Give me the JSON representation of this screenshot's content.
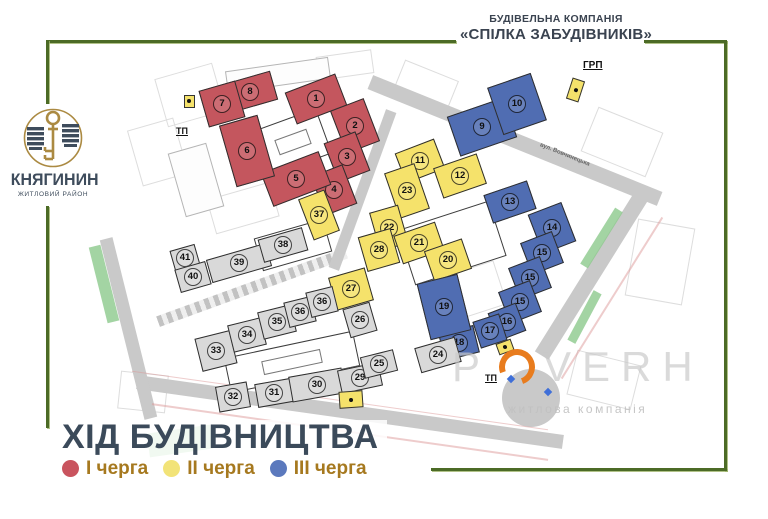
{
  "header": {
    "line1": "БУДІВЕЛЬНА КОМПАНІЯ",
    "line2": "«СПІЛКА ЗАБУДІВНИКІВ»"
  },
  "logo": {
    "name": "КНЯГИНИН",
    "subtitle": "ЖИТЛОВИЙ РАЙОН",
    "gold": "#ab8a42",
    "dark": "#3e4c5c"
  },
  "title": "ХІД БУДІВНИЦТВА",
  "legend": [
    {
      "label": "І черга",
      "color": "#c9545e"
    },
    {
      "label": "ІІ черга",
      "color": "#f2e378"
    },
    {
      "label": "ІІІ черга",
      "color": "#5b79bd"
    }
  ],
  "watermark": {
    "part1": "P",
    "part2": "VERH",
    "subtitle": "житлова компанія",
    "accent": "#e87c1e"
  },
  "frame_color": "#4c6b26",
  "map": {
    "colors": {
      "phase1": "#c4565e",
      "phase2": "#f5e26b",
      "phase3": "#506db2",
      "gray": "#d9d9d9",
      "road": "#c9c9c9",
      "green": "#8cc98c",
      "outline": "#2e2e2e"
    },
    "shapes": [
      {
        "t": "parcel",
        "x": 190,
        "y": 95,
        "w": 60,
        "h": 50,
        "r": -16
      },
      {
        "t": "parcel",
        "x": 158,
        "y": 152,
        "w": 48,
        "h": 58,
        "r": -16
      },
      {
        "t": "parcel",
        "x": 425,
        "y": 88,
        "w": 58,
        "h": 38,
        "r": 22
      },
      {
        "t": "parcel",
        "x": 622,
        "y": 142,
        "w": 70,
        "h": 48,
        "r": 22
      },
      {
        "t": "parcel",
        "x": 660,
        "y": 262,
        "w": 58,
        "h": 78,
        "r": 10
      },
      {
        "t": "parcel",
        "x": 470,
        "y": 292,
        "w": 64,
        "h": 46,
        "r": -18
      },
      {
        "t": "parcel",
        "x": 243,
        "y": 208,
        "w": 66,
        "h": 36,
        "r": -16
      },
      {
        "t": "parcel",
        "x": 604,
        "y": 380,
        "w": 66,
        "h": 46,
        "r": 14
      },
      {
        "t": "parcel",
        "x": 143,
        "y": 392,
        "w": 48,
        "h": 38,
        "r": 6
      },
      {
        "t": "parcel",
        "x": 345,
        "y": 65,
        "w": 56,
        "h": 24,
        "r": -8
      },
      {
        "t": "road",
        "x": 515,
        "y": 140,
        "w": 312,
        "h": 15,
        "r": 22
      },
      {
        "t": "road",
        "x": 592,
        "y": 275,
        "w": 16,
        "h": 190,
        "r": 32
      },
      {
        "t": "road",
        "x": 350,
        "y": 412,
        "w": 430,
        "h": 14,
        "r": 8
      },
      {
        "t": "road",
        "x": 128,
        "y": 328,
        "w": 13,
        "h": 185,
        "r": -14
      },
      {
        "t": "roadz",
        "x": 252,
        "y": 287,
        "w": 200,
        "h": 11,
        "r": -20
      },
      {
        "t": "road",
        "x": 362,
        "y": 190,
        "w": 11,
        "h": 168,
        "r": 20
      },
      {
        "t": "green",
        "x": 601,
        "y": 238,
        "w": 9,
        "h": 66,
        "r": 32
      },
      {
        "t": "green",
        "x": 584,
        "y": 317,
        "w": 9,
        "h": 56,
        "r": 28
      },
      {
        "t": "green",
        "x": 180,
        "y": 441,
        "w": 64,
        "h": 24,
        "r": -8
      },
      {
        "t": "green",
        "x": 104,
        "y": 284,
        "w": 12,
        "h": 78,
        "r": -14
      },
      {
        "t": "junction",
        "x": 531,
        "y": 398,
        "w": 58,
        "h": 58,
        "r": 0
      },
      {
        "t": "rline",
        "x": 350,
        "y": 432,
        "w": 400,
        "h": 2,
        "r": 8
      },
      {
        "t": "rline",
        "x": 340,
        "y": 400,
        "w": 420,
        "h": 1,
        "r": 8
      },
      {
        "t": "rline",
        "x": 612,
        "y": 298,
        "w": 2,
        "h": 190,
        "r": 32
      },
      {
        "t": "faint",
        "x": 278,
        "y": 75,
        "w": 104,
        "h": 22,
        "r": -8
      },
      {
        "t": "faint",
        "x": 196,
        "y": 180,
        "w": 40,
        "h": 66,
        "r": -16
      },
      {
        "t": "white",
        "x": 293,
        "y": 142,
        "w": 66,
        "h": 48,
        "r": -20
      },
      {
        "t": "inner",
        "x": 293,
        "y": 142,
        "w": 34,
        "h": 16,
        "r": -20
      },
      {
        "t": "white",
        "x": 293,
        "y": 245,
        "w": 72,
        "h": 34,
        "r": -16
      },
      {
        "t": "white",
        "x": 452,
        "y": 243,
        "w": 96,
        "h": 58,
        "r": -18
      },
      {
        "t": "white",
        "x": 292,
        "y": 362,
        "w": 132,
        "h": 36,
        "r": -12
      },
      {
        "t": "inner",
        "x": 292,
        "y": 362,
        "w": 60,
        "h": 14,
        "r": -12
      }
    ],
    "buildings": [
      {
        "n": "8",
        "p": 1,
        "x": 250,
        "y": 92,
        "w": 50,
        "h": 30,
        "r": -16
      },
      {
        "n": "7",
        "p": 1,
        "x": 222,
        "y": 104,
        "w": 38,
        "h": 38,
        "r": -16
      },
      {
        "n": "1",
        "p": 1,
        "x": 316,
        "y": 99,
        "w": 54,
        "h": 34,
        "r": -21
      },
      {
        "n": "2",
        "p": 1,
        "x": 355,
        "y": 126,
        "w": 36,
        "h": 46,
        "r": -21
      },
      {
        "n": "3",
        "p": 1,
        "x": 347,
        "y": 157,
        "w": 34,
        "h": 42,
        "r": -21
      },
      {
        "n": "4",
        "p": 1,
        "x": 334,
        "y": 190,
        "w": 34,
        "h": 42,
        "r": -21
      },
      {
        "n": "5",
        "p": 1,
        "x": 296,
        "y": 179,
        "w": 62,
        "h": 36,
        "r": -21
      },
      {
        "n": "6",
        "p": 1,
        "x": 247,
        "y": 151,
        "w": 40,
        "h": 64,
        "r": -16
      },
      {
        "n": "37",
        "p": 2,
        "x": 319,
        "y": 215,
        "w": 28,
        "h": 44,
        "r": -21
      },
      {
        "n": "11",
        "p": 2,
        "x": 420,
        "y": 161,
        "w": 42,
        "h": 32,
        "r": -21
      },
      {
        "n": "12",
        "p": 2,
        "x": 460,
        "y": 176,
        "w": 46,
        "h": 32,
        "r": -19
      },
      {
        "n": "23",
        "p": 2,
        "x": 407,
        "y": 191,
        "w": 32,
        "h": 48,
        "r": -19
      },
      {
        "n": "22",
        "p": 2,
        "x": 389,
        "y": 228,
        "w": 30,
        "h": 40,
        "r": -16
      },
      {
        "n": "21",
        "p": 2,
        "x": 419,
        "y": 243,
        "w": 44,
        "h": 30,
        "r": -19
      },
      {
        "n": "20",
        "p": 2,
        "x": 448,
        "y": 260,
        "w": 40,
        "h": 32,
        "r": -19
      },
      {
        "n": "28",
        "p": 2,
        "x": 379,
        "y": 250,
        "w": 34,
        "h": 36,
        "r": -16
      },
      {
        "n": "27",
        "p": 2,
        "x": 351,
        "y": 289,
        "w": 38,
        "h": 34,
        "r": -16
      },
      {
        "n": "9",
        "p": 3,
        "x": 482,
        "y": 127,
        "w": 60,
        "h": 42,
        "r": -19
      },
      {
        "n": "10",
        "p": 3,
        "x": 517,
        "y": 104,
        "w": 46,
        "h": 50,
        "r": -19
      },
      {
        "n": "13",
        "p": 3,
        "x": 510,
        "y": 202,
        "w": 46,
        "h": 30,
        "r": -19
      },
      {
        "n": "14",
        "p": 3,
        "x": 552,
        "y": 228,
        "w": 36,
        "h": 42,
        "r": -21
      },
      {
        "n": "15",
        "p": 3,
        "x": 542,
        "y": 253,
        "w": 34,
        "h": 34,
        "r": -21
      },
      {
        "n": "15",
        "p": 3,
        "x": 530,
        "y": 278,
        "w": 34,
        "h": 34,
        "r": -21
      },
      {
        "n": "15",
        "p": 3,
        "x": 520,
        "y": 302,
        "w": 34,
        "h": 34,
        "r": -21
      },
      {
        "n": "16",
        "p": 3,
        "x": 507,
        "y": 322,
        "w": 30,
        "h": 30,
        "r": -21
      },
      {
        "n": "17",
        "p": 3,
        "x": 490,
        "y": 331,
        "w": 28,
        "h": 28,
        "r": -18
      },
      {
        "n": "18",
        "p": 3,
        "x": 459,
        "y": 343,
        "w": 36,
        "h": 28,
        "r": -14
      },
      {
        "n": "19",
        "p": 3,
        "x": 444,
        "y": 307,
        "w": 42,
        "h": 58,
        "r": -14
      },
      {
        "n": "41",
        "p": 0,
        "x": 185,
        "y": 258,
        "w": 26,
        "h": 22,
        "r": -16
      },
      {
        "n": "40",
        "p": 0,
        "x": 193,
        "y": 277,
        "w": 32,
        "h": 24,
        "r": -16
      },
      {
        "n": "39",
        "p": 0,
        "x": 239,
        "y": 263,
        "w": 62,
        "h": 24,
        "r": -16
      },
      {
        "n": "38",
        "p": 0,
        "x": 283,
        "y": 245,
        "w": 46,
        "h": 24,
        "r": -16
      },
      {
        "n": "33",
        "p": 0,
        "x": 216,
        "y": 351,
        "w": 36,
        "h": 34,
        "r": -14
      },
      {
        "n": "34",
        "p": 0,
        "x": 247,
        "y": 335,
        "w": 34,
        "h": 28,
        "r": -14
      },
      {
        "n": "35",
        "p": 0,
        "x": 277,
        "y": 322,
        "w": 34,
        "h": 28,
        "r": -14
      },
      {
        "n": "36",
        "p": 0,
        "x": 300,
        "y": 312,
        "w": 28,
        "h": 26,
        "r": -14
      },
      {
        "n": "36",
        "p": 0,
        "x": 322,
        "y": 302,
        "w": 28,
        "h": 26,
        "r": -14
      },
      {
        "n": "26",
        "p": 0,
        "x": 360,
        "y": 320,
        "w": 28,
        "h": 30,
        "r": -16
      },
      {
        "n": "32",
        "p": 0,
        "x": 233,
        "y": 397,
        "w": 32,
        "h": 26,
        "r": -10
      },
      {
        "n": "31",
        "p": 0,
        "x": 274,
        "y": 393,
        "w": 36,
        "h": 24,
        "r": -10
      },
      {
        "n": "30",
        "p": 0,
        "x": 317,
        "y": 385,
        "w": 54,
        "h": 26,
        "r": -10
      },
      {
        "n": "29",
        "p": 0,
        "x": 360,
        "y": 378,
        "w": 42,
        "h": 24,
        "r": -12
      },
      {
        "n": "25",
        "p": 0,
        "x": 379,
        "y": 364,
        "w": 34,
        "h": 22,
        "r": -14
      },
      {
        "n": "24",
        "p": 0,
        "x": 438,
        "y": 355,
        "w": 42,
        "h": 26,
        "r": -16
      }
    ],
    "markers": [
      {
        "t": "ybox",
        "x": 189,
        "y": 101,
        "w": 11,
        "h": 13,
        "r": 0
      },
      {
        "t": "ybox",
        "x": 575,
        "y": 90,
        "w": 13,
        "h": 22,
        "r": 18
      },
      {
        "t": "ybox",
        "x": 505,
        "y": 347,
        "w": 16,
        "h": 12,
        "r": -20
      },
      {
        "t": "ybox",
        "x": 351,
        "y": 399,
        "w": 24,
        "h": 17,
        "r": -4
      },
      {
        "t": "bdia",
        "x": 511,
        "y": 379,
        "w": 6,
        "h": 6,
        "r": 45
      },
      {
        "t": "bdia",
        "x": 548,
        "y": 392,
        "w": 6,
        "h": 6,
        "r": 45
      }
    ],
    "labels": [
      {
        "name": "tp-label-1",
        "text": "ТП",
        "x": 176,
        "y": 126,
        "fs": 9,
        "u": 1
      },
      {
        "name": "tp-label-2",
        "text": "ТП",
        "x": 485,
        "y": 373,
        "fs": 9,
        "u": 1
      },
      {
        "name": "grp-label",
        "text": "ГРП",
        "x": 583,
        "y": 60,
        "fs": 10,
        "u": 1
      },
      {
        "name": "street-label",
        "text": "вул. Вовчинецька",
        "x": 538,
        "y": 152,
        "fs": 6,
        "r": 22,
        "c": "#666666"
      }
    ]
  }
}
